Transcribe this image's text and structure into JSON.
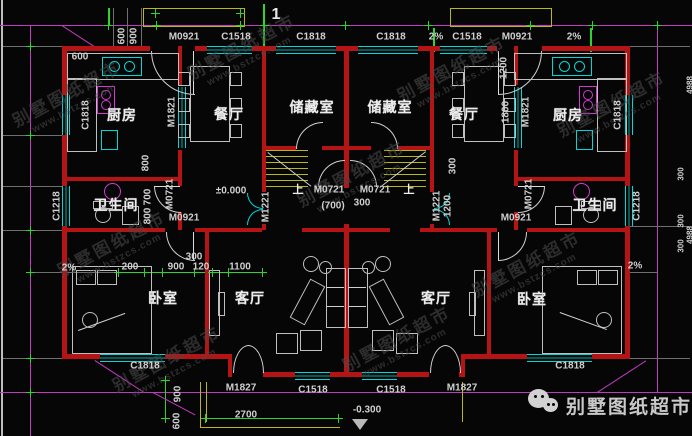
{
  "watermark": {
    "brand": "别墅图纸超市",
    "url": "www.bstzcs.com"
  },
  "footer": {
    "brand": "别墅图纸超市"
  },
  "axis": {
    "grid_1": "1"
  },
  "rooms": {
    "kitchen": "厨房",
    "dining": "餐厅",
    "storage": "储藏室",
    "bathroom": "卫生间",
    "bedroom": "卧室",
    "living_room": "客厅"
  },
  "stairs": {
    "up": "上"
  },
  "levels": {
    "main_floor": "±0.000",
    "porch": "-0.300"
  },
  "slope": {
    "two_percent": "2%"
  },
  "codes": {
    "M0921": "M0921",
    "M1821": "M1821",
    "M0721": "M0721",
    "M1221": "M1221",
    "M1827": "M1827",
    "C1818": "C1818",
    "C1518": "C1518",
    "C1218": "C1218"
  },
  "dims": {
    "d120": "120",
    "d200": "200",
    "d300": "300",
    "d600": "600",
    "d700": "700",
    "d700p": "(700)",
    "d800": "800",
    "d900": "900",
    "d1100": "1100",
    "d1200": "1200",
    "d1800": "1800",
    "d2700": "2700",
    "d4988": "4988"
  }
}
